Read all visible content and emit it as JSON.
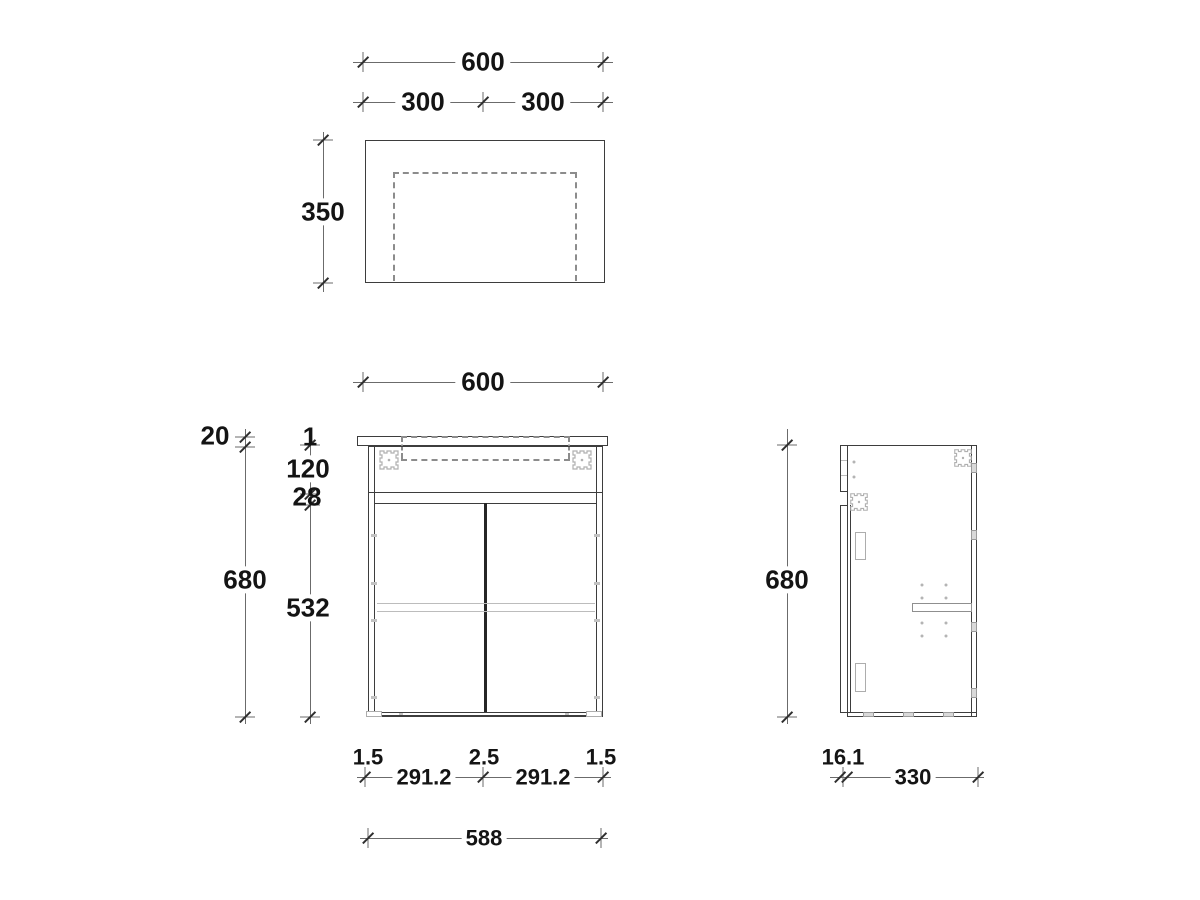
{
  "top_view": {
    "width_total": "600",
    "width_left": "300",
    "width_right": "300",
    "depth": "350"
  },
  "front_view": {
    "width_total": "600",
    "countertop_thickness": "20",
    "top_gap": "1",
    "top_section_height": "120",
    "rail_height": "28",
    "cabinet_height": "680",
    "door_height": "532",
    "side_gap_left": "1.5",
    "door_width_left": "291.2",
    "center_gap": "2.5",
    "door_width_right": "291.2",
    "side_gap_right": "1.5",
    "carcass_width": "588"
  },
  "side_view": {
    "cabinet_height": "680",
    "door_thickness": "16.1",
    "body_depth": "330"
  },
  "colors": {
    "line": "#3d3d3d",
    "dim_line": "#6b6b6b",
    "light_detail": "#b4b4b4",
    "dashed": "#8c8c8c",
    "text": "#141414",
    "background": "#ffffff"
  }
}
